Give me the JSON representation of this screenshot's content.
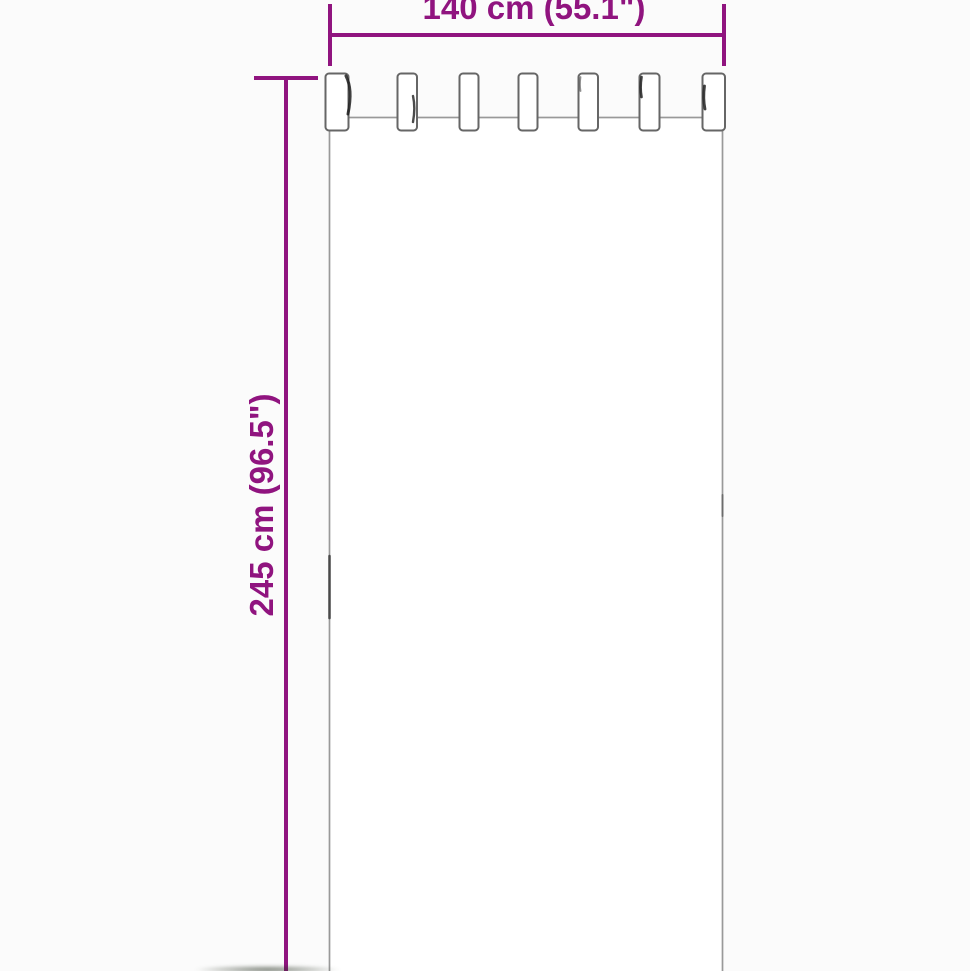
{
  "dimensions": {
    "width": {
      "label": "140 cm (55.1\")",
      "value_cm": 140,
      "value_inch": 55.1
    },
    "height": {
      "label": "245 cm (96.5\")",
      "value_cm": 245,
      "value_inch": 96.5
    }
  },
  "figure": {
    "name": "tab-top-curtain",
    "tab_count": 7
  },
  "colors": {
    "dimension_accent": "#90147F",
    "outline_gray": "#999999",
    "tab_outline_gray": "#666666",
    "fold_shadow": "#222222",
    "background": "#fbfbfb",
    "curtain_fill": "#ffffff"
  }
}
